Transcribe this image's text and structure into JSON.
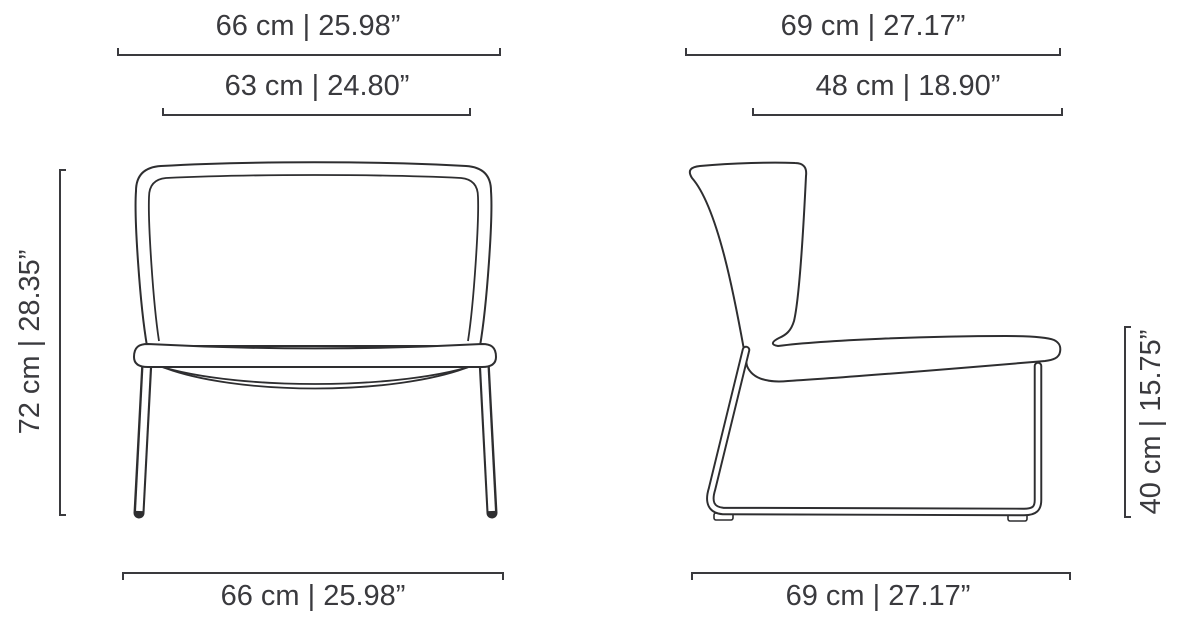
{
  "diagram": {
    "subject": "lounge chair dimensional drawing",
    "views": [
      "front",
      "side"
    ]
  },
  "colors": {
    "background": "#ffffff",
    "drawing_line": "#2e2e30",
    "dimension_text": "#3a3a3e"
  },
  "dims": {
    "front_top_outer": "66 cm | 25.98”",
    "front_top_inner": "63 cm | 24.80”",
    "front_left": "72 cm | 28.35”",
    "front_bottom": "66 cm | 25.98”",
    "side_top_outer": "69 cm | 27.17”",
    "side_top_inner": "48 cm | 18.90”",
    "side_right": "40 cm | 15.75”",
    "side_bottom": "69 cm | 27.17”"
  },
  "measurements": [
    {
      "view": "front",
      "dimension": "overall width",
      "cm": 66,
      "inches": 25.98
    },
    {
      "view": "front",
      "dimension": "upper width",
      "cm": 63,
      "inches": 24.8
    },
    {
      "view": "front",
      "dimension": "overall height",
      "cm": 72,
      "inches": 28.35
    },
    {
      "view": "front",
      "dimension": "base width",
      "cm": 66,
      "inches": 25.98
    },
    {
      "view": "side",
      "dimension": "overall depth",
      "cm": 69,
      "inches": 27.17
    },
    {
      "view": "side",
      "dimension": "seat depth",
      "cm": 48,
      "inches": 18.9
    },
    {
      "view": "side",
      "dimension": "seat height",
      "cm": 40,
      "inches": 15.75
    },
    {
      "view": "side",
      "dimension": "base depth",
      "cm": 69,
      "inches": 27.17
    }
  ]
}
